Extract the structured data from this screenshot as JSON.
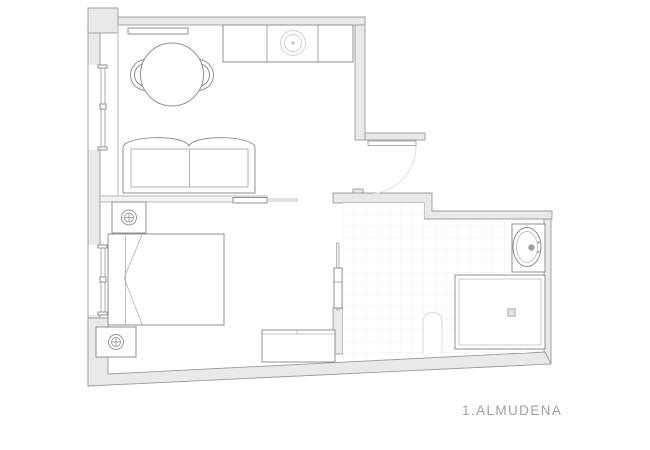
{
  "plan": {
    "title": "1.ALMUDENA"
  },
  "colors": {
    "background": "#ffffff",
    "wall_fill": "#e9e9e9",
    "wall_stroke": "#9a9a9a",
    "furniture_stroke": "#8f8f8f",
    "light_detail": "#c9c9c9",
    "tile_line": "#efefef",
    "label": "#9aa0a5"
  },
  "fixtures": [
    "dining-table",
    "dining-chair",
    "kitchen-counter",
    "cooktop-burner",
    "wall-shelf",
    "sofa",
    "double-bed",
    "nightstand",
    "table-lamp",
    "bench",
    "sliding-door",
    "entry-door",
    "window",
    "toilet",
    "shower-tray",
    "shower-drain",
    "washbasin",
    "bathroom-tiles"
  ]
}
